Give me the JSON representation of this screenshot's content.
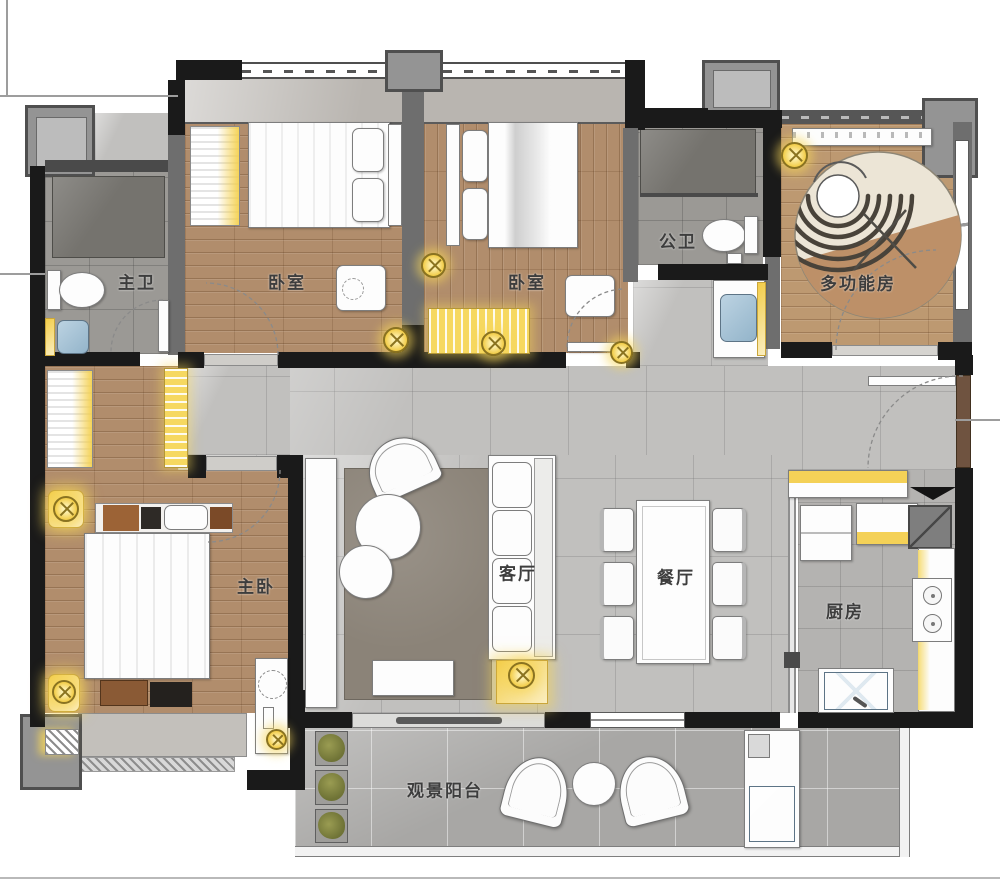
{
  "floor_plan": {
    "type": "residential-apartment-floor-plan",
    "rooms": [
      {
        "key": "master_bath",
        "label": "主卫"
      },
      {
        "key": "bedroom_a",
        "label": "卧室"
      },
      {
        "key": "bedroom_b",
        "label": "卧室"
      },
      {
        "key": "public_bath",
        "label": "公卫"
      },
      {
        "key": "multi_function",
        "label": "多功能房"
      },
      {
        "key": "master_bedroom",
        "label": "主卧"
      },
      {
        "key": "living",
        "label": "客厅"
      },
      {
        "key": "dining",
        "label": "餐厅"
      },
      {
        "key": "kitchen",
        "label": "厨房"
      },
      {
        "key": "balcony",
        "label": "观景阳台"
      }
    ],
    "colors": {
      "wall": "#1a1a1a",
      "wood_floor": "#b18d6c",
      "stone_floor": "#c1c0be",
      "balcony_floor": "#a8a7a5",
      "accent_light": "#f2cb4a",
      "water_fixture": "#a9c3d4",
      "living_rug": "#8b8378",
      "multi_rug_base": "#ece5d6",
      "multi_rug_accent": "#bd9068"
    }
  }
}
